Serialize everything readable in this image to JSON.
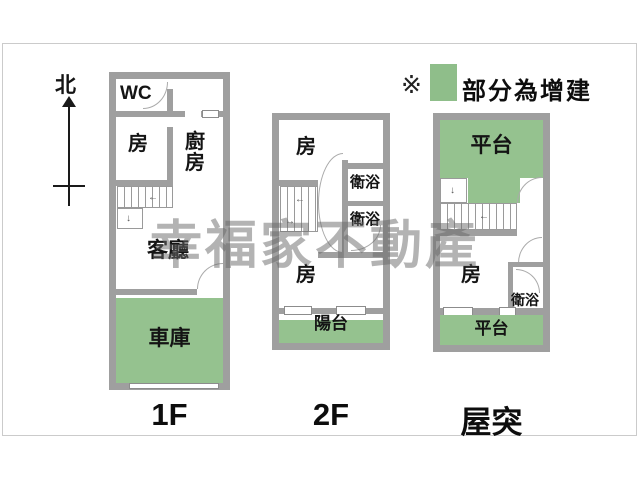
{
  "compass": {
    "label": "北"
  },
  "legend": {
    "marker": "※",
    "text": "部分為增建",
    "swatch_color": "#8fbe8a"
  },
  "watermark": {
    "text": "幸福家不動產"
  },
  "icons": {
    "left_arrow": "←",
    "right_arrow": "→",
    "down_arrow": "↓"
  },
  "colors": {
    "addition_green": "#95c28f",
    "wall_gray": "#9f9f9f",
    "card_border": "#cbcbcb"
  },
  "floors": [
    {
      "caption": "1F",
      "rooms": [
        {
          "name": "wc",
          "label": "WC",
          "addition": false
        },
        {
          "name": "bedroom",
          "label": "房",
          "addition": false
        },
        {
          "name": "kitchen",
          "label": "廚房",
          "addition": false
        },
        {
          "name": "living-room",
          "label": "客廳",
          "addition": false
        },
        {
          "name": "garage",
          "label": "車庫",
          "addition": true
        }
      ]
    },
    {
      "caption": "2F",
      "rooms": [
        {
          "name": "bedroom-front",
          "label": "房",
          "addition": false
        },
        {
          "name": "bathroom-upper",
          "label": "衛浴",
          "addition": false
        },
        {
          "name": "bathroom-lower",
          "label": "衛浴",
          "addition": false
        },
        {
          "name": "bedroom-rear",
          "label": "房",
          "addition": false
        },
        {
          "name": "balcony",
          "label": "陽台",
          "addition": true
        }
      ]
    },
    {
      "caption": "屋突",
      "rooms": [
        {
          "name": "terrace-top",
          "label": "平台",
          "addition": true
        },
        {
          "name": "bedroom",
          "label": "房",
          "addition": false
        },
        {
          "name": "bathroom",
          "label": "衛浴",
          "addition": false
        },
        {
          "name": "terrace-bottom",
          "label": "平台",
          "addition": true
        }
      ]
    }
  ]
}
